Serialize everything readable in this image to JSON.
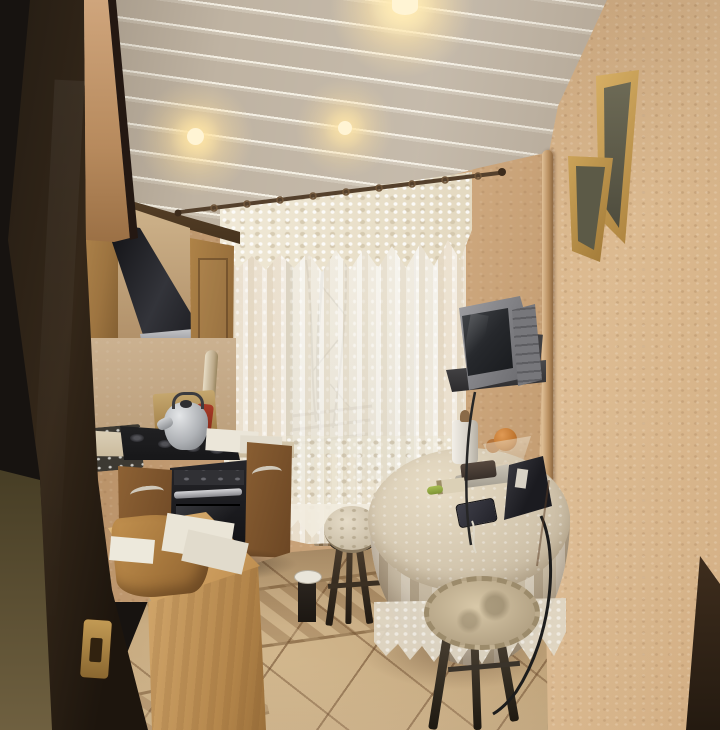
{
  "scene": {
    "type": "interior photograph",
    "setting": "small apartment kitchen seen through an open dark door",
    "lighting": "warm ceiling dome lights and daylight through lace curtains",
    "ceiling_lights_visible": 3,
    "picture_frames_visible": 2,
    "stools_visible": 3
  },
  "palette": {
    "ceiling": "#cdc3b3",
    "back_wall": "#c59e74",
    "right_wallpaper": "#d2a97c",
    "cabinets": "#a87c46",
    "door": "#241b13",
    "curtain": "#ece4d0",
    "window_light": "#e3e9ec",
    "floor_tile": "#c9ac82",
    "tablecloth": "#cfc2ab",
    "appliances": "#1c1c1e",
    "tv": "#8d8d90",
    "frame_gold": "#c8a055"
  },
  "objects": {
    "door": {
      "label": "Open dark-brown door"
    },
    "door_latch": {
      "label": "Brass latch plate on door edge"
    },
    "hall_wall": {
      "label": "Olive hallway wall"
    },
    "ceiling": {
      "label": "Slatted beige ceiling"
    },
    "ceiling_light": {
      "label": "Round warm ceiling light"
    },
    "right_wall": {
      "label": "Textured wallpaper wall"
    },
    "picture_frames": {
      "label": "Gold picture frames seen edge-on"
    },
    "corner_pipe": {
      "label": "Vertical pipe in wall corner"
    },
    "window": {
      "label": "Daylit window with tree branches"
    },
    "curtain_rod": {
      "label": "Dark curtain rod with rings"
    },
    "valance": {
      "label": "Lace valance"
    },
    "curtains": {
      "label": "Sheer lace curtains"
    },
    "radiator": {
      "label": "Radiator under window"
    },
    "upper_cabinets": {
      "label": "Oak upper kitchen cabinets"
    },
    "range_hood": {
      "label": "Black cone range hood"
    },
    "backsplash": {
      "label": "Beige wall behind counter"
    },
    "gas_pipe": {
      "label": "Cream gas pipe"
    },
    "cutting_board": {
      "label": "Wooden cutting board"
    },
    "red_item": {
      "label": "Red utensil behind kettle"
    },
    "trivet": {
      "label": "Dark patterned board"
    },
    "countertop": {
      "label": "Beige countertop"
    },
    "cooktop": {
      "label": "Black gas cooktop"
    },
    "kettle": {
      "label": "Stainless kettle"
    },
    "papers_counter": {
      "label": "White papers on counter"
    },
    "oven": {
      "label": "Built-in black oven"
    },
    "base_cabinets": {
      "label": "Oak base cabinet doors"
    },
    "tv": {
      "label": "Grey CRT TV on wall bracket"
    },
    "tv_bracket": {
      "label": "Dark TV wall bracket"
    },
    "floor": {
      "label": "Beige tile floor with ornamental band"
    },
    "table": {
      "label": "Round table with lace tablecloth"
    },
    "paper_towel": {
      "label": "Paper towel roll"
    },
    "fruit_bowl": {
      "label": "Glass pedestal bowl with orange fruit"
    },
    "tray": {
      "label": "Metal tray with item"
    },
    "telephone": {
      "label": "Black corded telephone"
    },
    "smartphone": {
      "label": "Smartphone on table"
    },
    "matchbox": {
      "label": "Matchbox"
    },
    "lighter": {
      "label": "Green lighter"
    },
    "stool_left": {
      "label": "Stool with patterned cushion"
    },
    "stool_right": {
      "label": "Stool with fringed round cushion"
    },
    "stool_corner": {
      "label": "Corner stool with white dish"
    },
    "bread_counter": {
      "label": "Light wood cabinet with curved bread board"
    },
    "papers_foreground": {
      "label": "Papers on foreground cabinet"
    },
    "cables": {
      "label": "Hanging cables and cords"
    }
  }
}
